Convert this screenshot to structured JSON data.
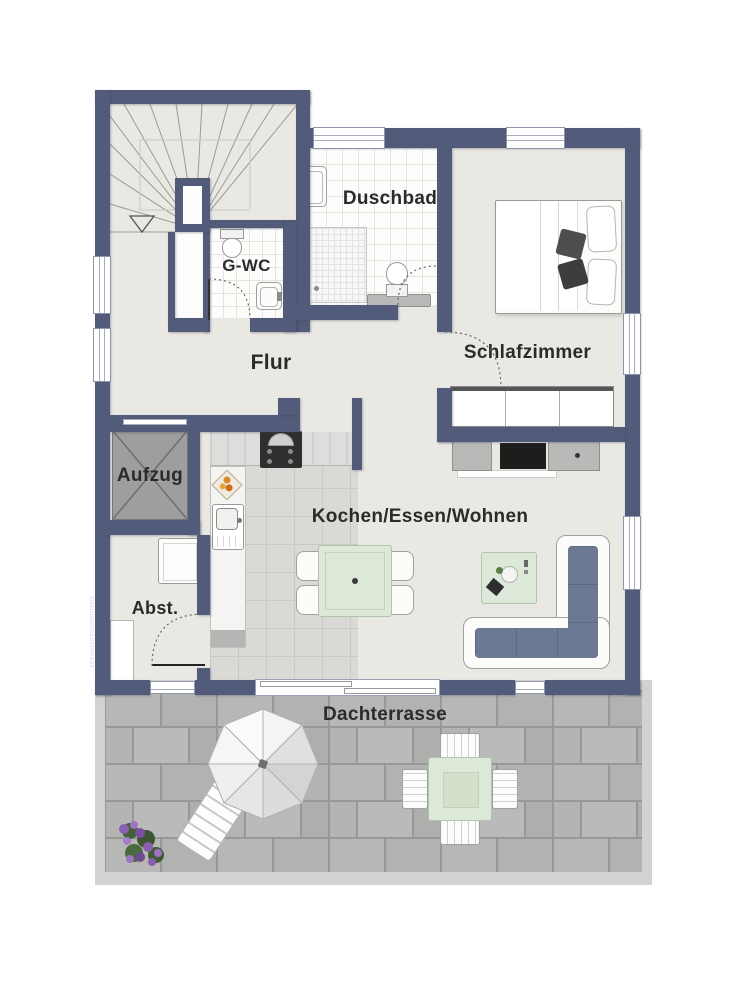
{
  "floorplan": {
    "rooms": {
      "duschbad": {
        "label": "Duschbad"
      },
      "gwc": {
        "label": "G-WC"
      },
      "flur": {
        "label": "Flur"
      },
      "schlafzimmer": {
        "label": "Schlafzimmer"
      },
      "aufzug": {
        "label": "Aufzug"
      },
      "abstellraum": {
        "label": "Abst."
      },
      "kochen_essen_wohnen": {
        "label": "Kochen/Essen/Wohnen"
      },
      "dachterrasse": {
        "label": "Dachterrasse"
      }
    },
    "watermark": "dieGrundrissSchmiede",
    "colors": {
      "wall": "#525b7a",
      "floor": "#eae8e2",
      "bathroom_tile": "#fdfdfb",
      "kitchen_tile": "#d9d9d6",
      "terrace_tile": "#b6b6b4",
      "terrace_border": "#d2d2d0",
      "furniture_green": "#dce8d8",
      "sofa_cushion": "#6d7894",
      "elevator_gray": "#9e9e9c",
      "flower_purple": "#8a5fae"
    },
    "furniture": [
      "staircase",
      "winder-stairs-arrow",
      "double-bed",
      "wardrobe",
      "tv-sideboard",
      "corner-sofa",
      "coffee-table",
      "dining-table-with-chairs",
      "kitchen-counter",
      "stove-with-hood",
      "kitchen-sink",
      "fruit-bowl",
      "washing-machine",
      "storage-shelf",
      "shower",
      "bathroom-sink",
      "toilet",
      "bench",
      "parasol",
      "sun-lounger",
      "terrace-table-with-chairs",
      "flower-planter"
    ]
  }
}
